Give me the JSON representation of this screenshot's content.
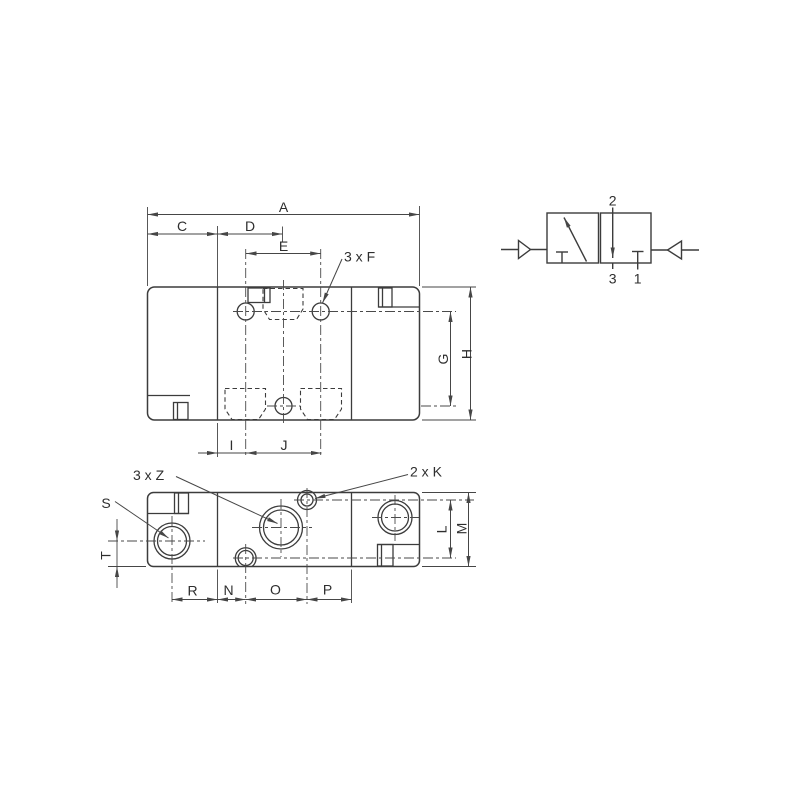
{
  "figure": {
    "type": "technical-dimension-drawing",
    "subject": "pneumatic 3/2 valve body with dimension callouts and circuit symbol",
    "colors": {
      "background": "#ffffff",
      "line": "#3c3c3c",
      "text": "#2e2e2e"
    },
    "top_view": {
      "dims": {
        "a": "A",
        "c": "C",
        "d": "D",
        "e": "E",
        "f": "3 x F",
        "g": "G",
        "h": "H",
        "i": "I",
        "j": "J"
      }
    },
    "bottom_view": {
      "dims": {
        "z": "3 x Z",
        "k": "2 x K",
        "s": "S",
        "t": "T",
        "l": "L",
        "m": "M",
        "r": "R",
        "n": "N",
        "o": "O",
        "p": "P"
      }
    },
    "symbol": {
      "ports": {
        "top": "2",
        "bottom_left": "3",
        "bottom_right": "1"
      }
    }
  }
}
